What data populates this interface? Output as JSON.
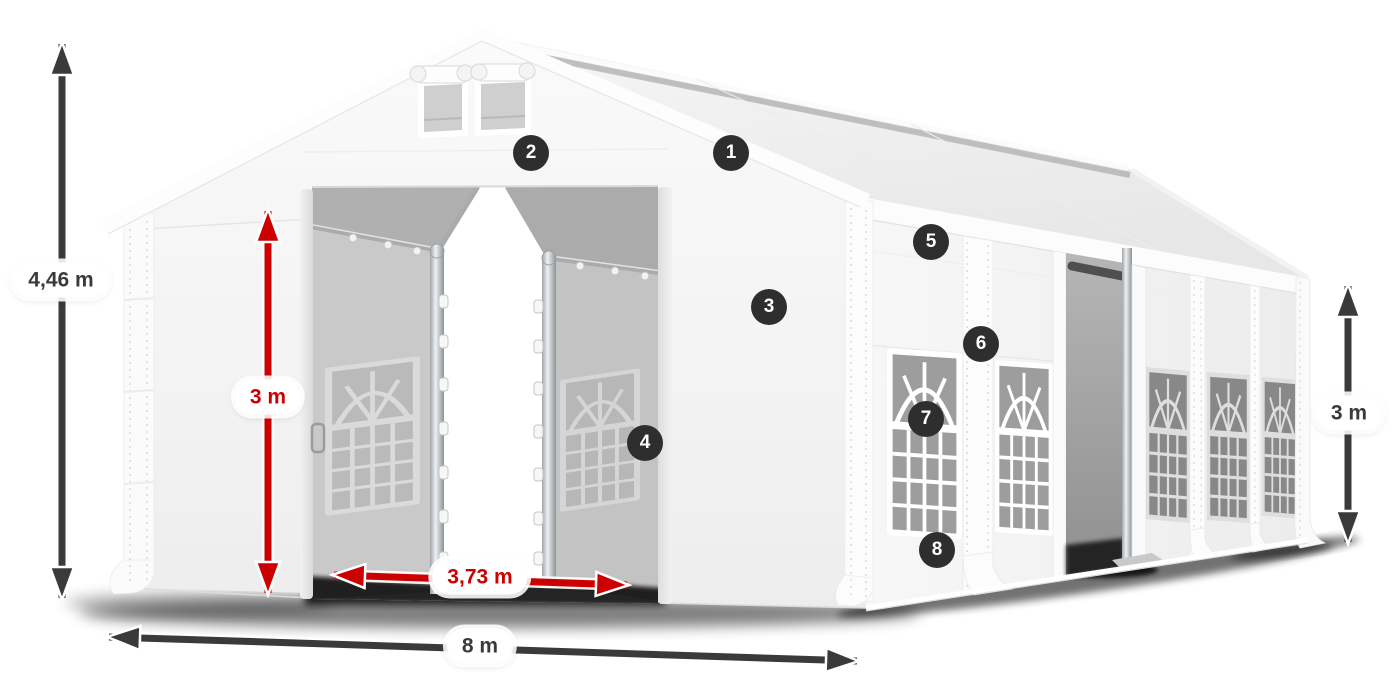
{
  "colors": {
    "page-bg": "#ffffff",
    "arrow-dark": "#3a3a3a",
    "arrow-red": "#cc0001",
    "marker-bg": "#2e2e2e",
    "marker-text": "#ffffff",
    "pill-bg": "#ffffff",
    "pill-text-dark": "#3a3a3a",
    "tent-white": "#f5f5f5",
    "interior-gray": "#c4c4c4",
    "glass-gray": "#9d9d9d"
  },
  "dimensions": {
    "total_height": {
      "label": "4,46 m",
      "style": "dark",
      "orientation": "vertical"
    },
    "inner_height": {
      "label": "3 m",
      "style": "red",
      "orientation": "vertical"
    },
    "entrance_width": {
      "label": "3,73 m",
      "style": "red",
      "orientation": "horizontal"
    },
    "total_length": {
      "label": "8 m",
      "style": "dark",
      "orientation": "horizontal"
    },
    "side_height": {
      "label": "3 m",
      "style": "dark",
      "orientation": "vertical"
    }
  },
  "markers": [
    {
      "label": "1"
    },
    {
      "label": "2"
    },
    {
      "label": "3"
    },
    {
      "label": "4"
    },
    {
      "label": "5"
    },
    {
      "label": "6"
    },
    {
      "label": "7"
    },
    {
      "label": "8"
    }
  ]
}
